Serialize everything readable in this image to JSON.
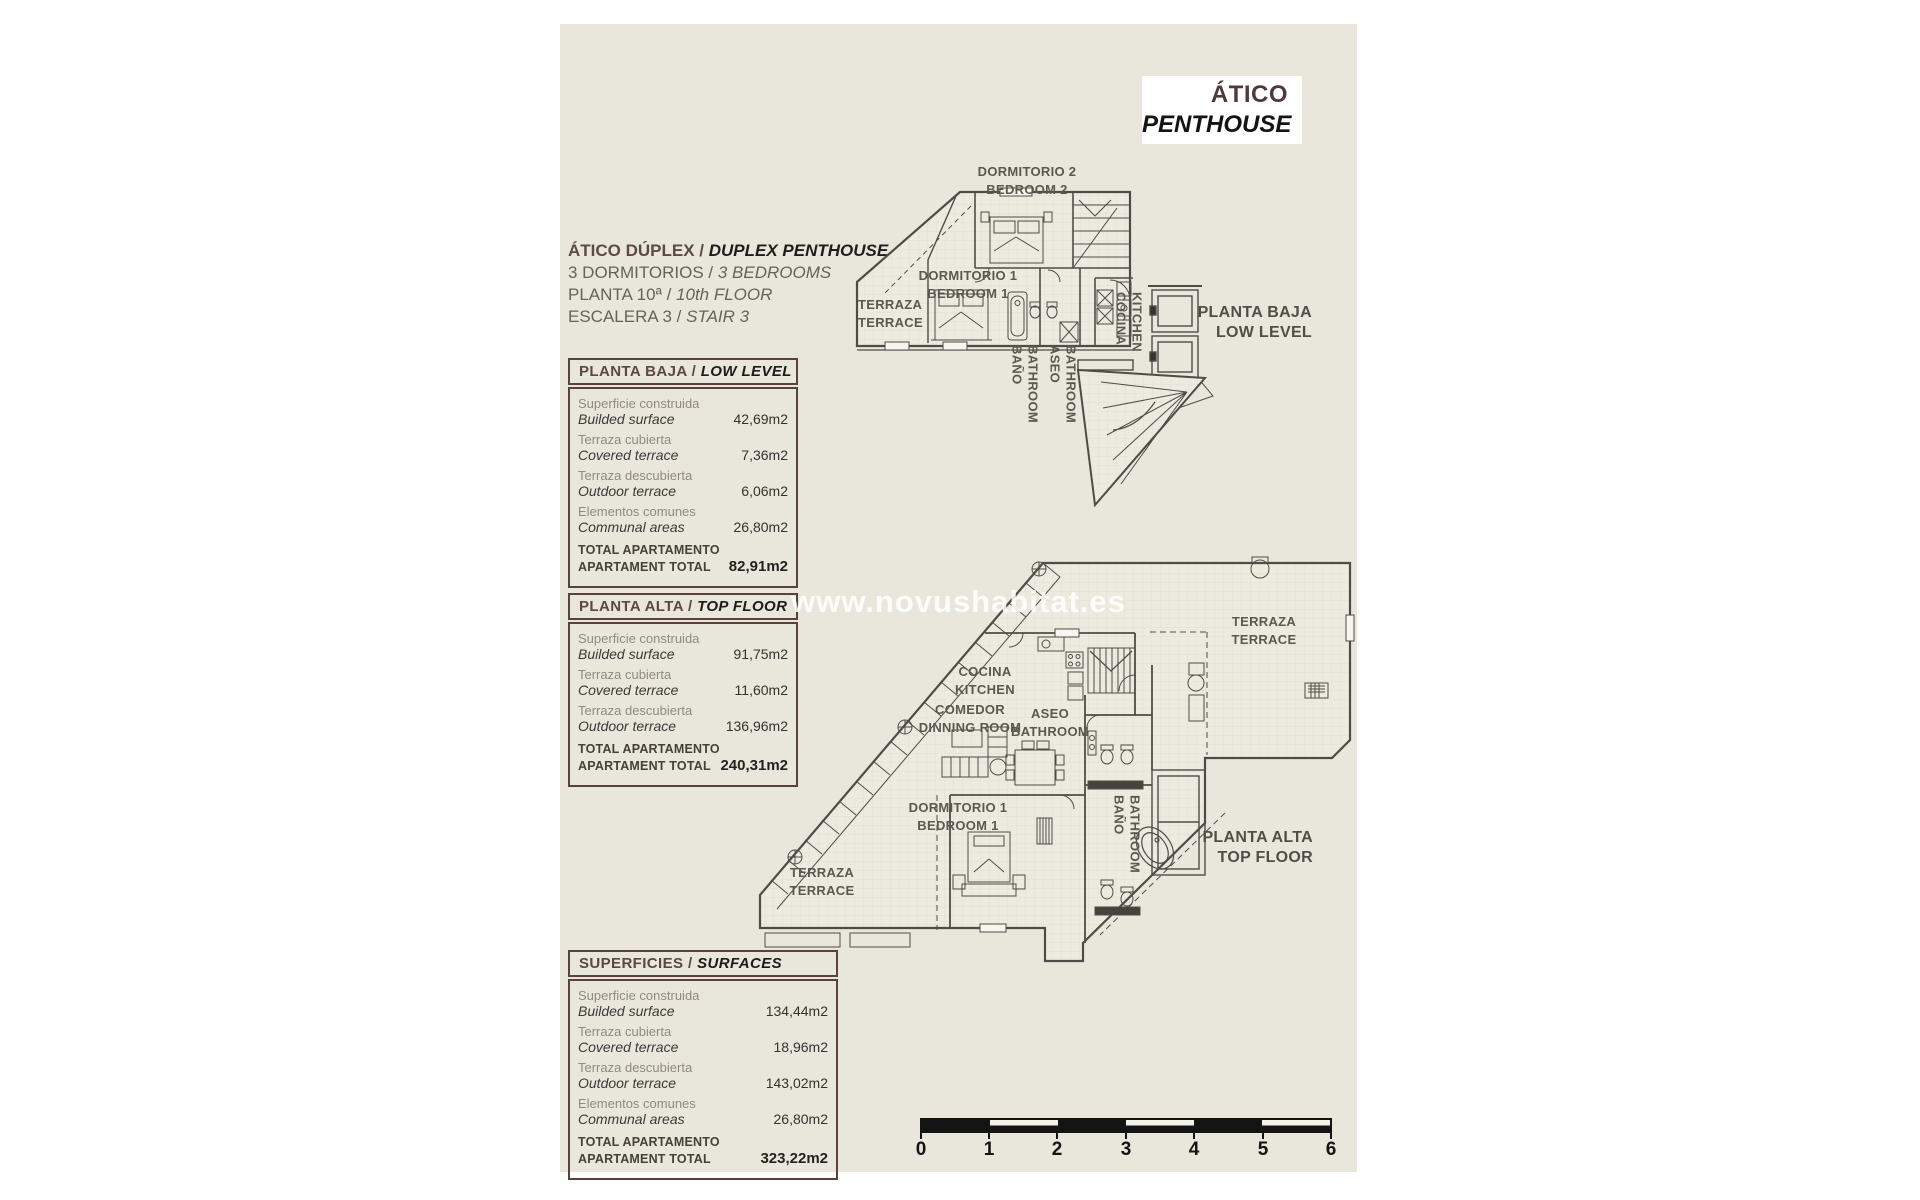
{
  "page": {
    "title_box": {
      "title_es": "ÁTICO",
      "title_en": "PENTHOUSE"
    },
    "info": {
      "line1_es": "ÁTICO DÚPLEX / ",
      "line1_en": "DUPLEX PENTHOUSE",
      "line2_es": "3 DORMITORIOS / ",
      "line2_en": "3 BEDROOMS",
      "line3_es": "PLANTA 10ª / ",
      "line3_en": "10th FLOOR",
      "line4_es": "ESCALERA 3 / ",
      "line4_en": "STAIR 3"
    },
    "watermark": "www.novushabitat.es"
  },
  "tables": [
    {
      "header_es": "PLANTA BAJA / ",
      "header_en": "LOW LEVEL",
      "rows": [
        {
          "es": "Superficie construida",
          "en": "Builded surface",
          "value": "42,69m2"
        },
        {
          "es": "Terraza cubierta",
          "en": "Covered terrace",
          "value": "7,36m2"
        },
        {
          "es": "Terraza descubierta",
          "en": "Outdoor terrace",
          "value": "6,06m2"
        },
        {
          "es": "Elementos comunes",
          "en": "Communal areas",
          "value": "26,80m2"
        }
      ],
      "total": {
        "es": "TOTAL APARTAMENTO",
        "en": "APARTAMENT TOTAL",
        "value": "82,91m2"
      }
    },
    {
      "header_es": "PLANTA ALTA / ",
      "header_en": "TOP FLOOR",
      "rows": [
        {
          "es": "Superficie construida",
          "en": "Builded surface",
          "value": "91,75m2"
        },
        {
          "es": "Terraza cubierta",
          "en": "Covered terrace",
          "value": "11,60m2"
        },
        {
          "es": "Terraza descubierta",
          "en": "Outdoor terrace",
          "value": "136,96m2"
        }
      ],
      "total": {
        "es": "TOTAL APARTAMENTO",
        "en": "APARTAMENT TOTAL",
        "value": "240,31m2"
      }
    },
    {
      "header_es": "SUPERFICIES / ",
      "header_en": "SURFACES",
      "rows": [
        {
          "es": "Superficie construida",
          "en": "Builded surface",
          "value": "134,44m2"
        },
        {
          "es": "Terraza cubierta",
          "en": "Covered terrace",
          "value": "18,96m2"
        },
        {
          "es": "Terraza descubierta",
          "en": "Outdoor terrace",
          "value": "143,02m2"
        },
        {
          "es": "Elementos comunes",
          "en": "Communal areas",
          "value": "26,80m2"
        }
      ],
      "total": {
        "es": "TOTAL APARTAMENTO",
        "en": "APARTAMENT TOTAL",
        "value": "323,22m2"
      }
    }
  ],
  "plans": {
    "upper": {
      "rooms": {
        "dormitorio2": "DORMITORIO 2\nBEDROOM 2",
        "dormitorio1": "DORMITORIO 1\nBEDROOM 1",
        "terraza": "TERRAZA\nTERRACE",
        "cocina": "COCINA\nKITCHEN",
        "bano": "BAÑO\nBATHROOM",
        "aseo": "ASEO\nBATHROOM"
      },
      "side_label": "PLANTA BAJA\nLOW LEVEL"
    },
    "lower": {
      "rooms": {
        "cocina": "COCINA\nKITCHEN",
        "comedor": "COMEDOR\nDINNING ROOM",
        "aseo": "ASEO\nBATHROOM",
        "terraza_top": "TERRAZA\nTERRACE",
        "dormitorio1": "DORMITORIO 1\nBEDROOM 1",
        "bano": "BAÑO\nBATHROOM",
        "terraza_bottom": "TERRAZA\nTERRACE"
      },
      "side_label": "PLANTA ALTA\nTOP FLOOR"
    }
  },
  "scalebar": {
    "ticks": [
      "0",
      "1",
      "2",
      "3",
      "4",
      "5",
      "6"
    ]
  },
  "colors": {
    "page_bg": "#e9e7dc",
    "accent_maroon": "#5a413c",
    "line": "#56544d"
  }
}
